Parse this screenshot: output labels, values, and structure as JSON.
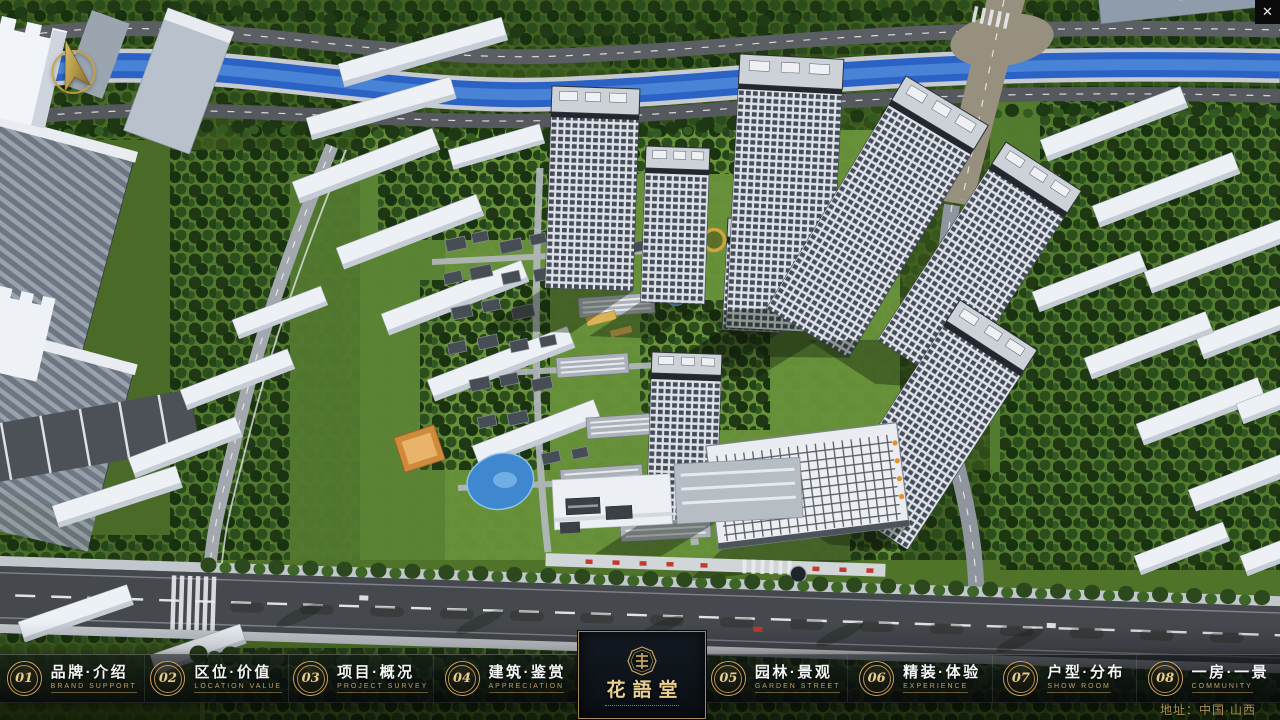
{
  "chrome": {
    "close_glyph": "✕"
  },
  "compass": {
    "icon": "gold-north-arrow"
  },
  "nav": {
    "items": [
      {
        "num": "01",
        "zh": "品牌·介绍",
        "en": "BRAND SUPPORT"
      },
      {
        "num": "02",
        "zh": "区位·价值",
        "en": "LOCATION VALUE"
      },
      {
        "num": "03",
        "zh": "项目·概况",
        "en": "PROJECT SURVEY"
      },
      {
        "num": "04",
        "zh": "建筑·鉴赏",
        "en": "APPRECIATION"
      },
      {
        "num": "05",
        "zh": "园林·景观",
        "en": "GARDEN STREET"
      },
      {
        "num": "06",
        "zh": "精装·体验",
        "en": "EXPERIENCE"
      },
      {
        "num": "07",
        "zh": "户型·分布",
        "en": "SHOW ROOM"
      },
      {
        "num": "08",
        "zh": "一房·一景",
        "en": "COMMUNITY"
      }
    ]
  },
  "logo": {
    "title": "花語堂",
    "seal": "octagonal-brand-seal"
  },
  "footer": {
    "address": "地址：中国·山西"
  },
  "scene": {
    "type": "aerial-3d-masterplan",
    "subject": "bird's-eye render of residential community with river, ring roads, white towers and courtyard houses",
    "accent_gold": "#c9a55e",
    "water_blue": "#2b63c8"
  }
}
